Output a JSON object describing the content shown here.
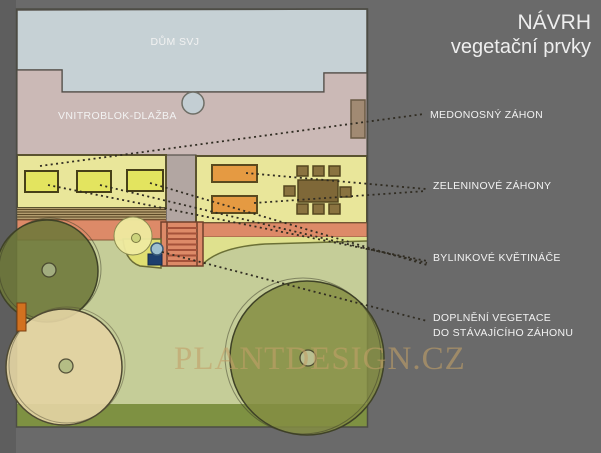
{
  "title": {
    "line1": "NÁVRH",
    "line2": "vegetační prvky"
  },
  "plan": {
    "building_label": "DŮM SVJ",
    "paving_label": "VNITROBLOK-DLAŽBA",
    "watermark": "PLANTDESIGN.CZ"
  },
  "annotations": [
    {
      "label": "MEDONOSNÝ ZÁHON"
    },
    {
      "label": "ZELENINOVÉ ZÁHONY"
    },
    {
      "label": "BYLINKOVÉ KVĚTINÁČE"
    },
    {
      "label": "DOPLNĚNÍ VEGETACE",
      "label2": "DO STÁVAJÍCÍHO ZÁHONU"
    }
  ],
  "palette": {
    "background": "#6a6a6a",
    "building": "#c6d1d5",
    "paving": "#cbb9b6",
    "bed_strip_yellow": "#e9e69a",
    "planter_yellow": "#e3e45f",
    "vegetable_orange": "#e59a42",
    "terracotta": "#dd8a68",
    "lawn_green": "#c5cd98",
    "lawn_edge_green": "#7e9142",
    "tree_olive": "#6d7739",
    "tree_beige": "#e3d4a3",
    "wood_brown": "#8a7340",
    "pot_blue": "#9fc0d0",
    "pot_navy": "#1e3f6e",
    "watermark_tan": "#c2a068",
    "label_text": "#f2f2f2",
    "leader_line": "#302c22"
  }
}
